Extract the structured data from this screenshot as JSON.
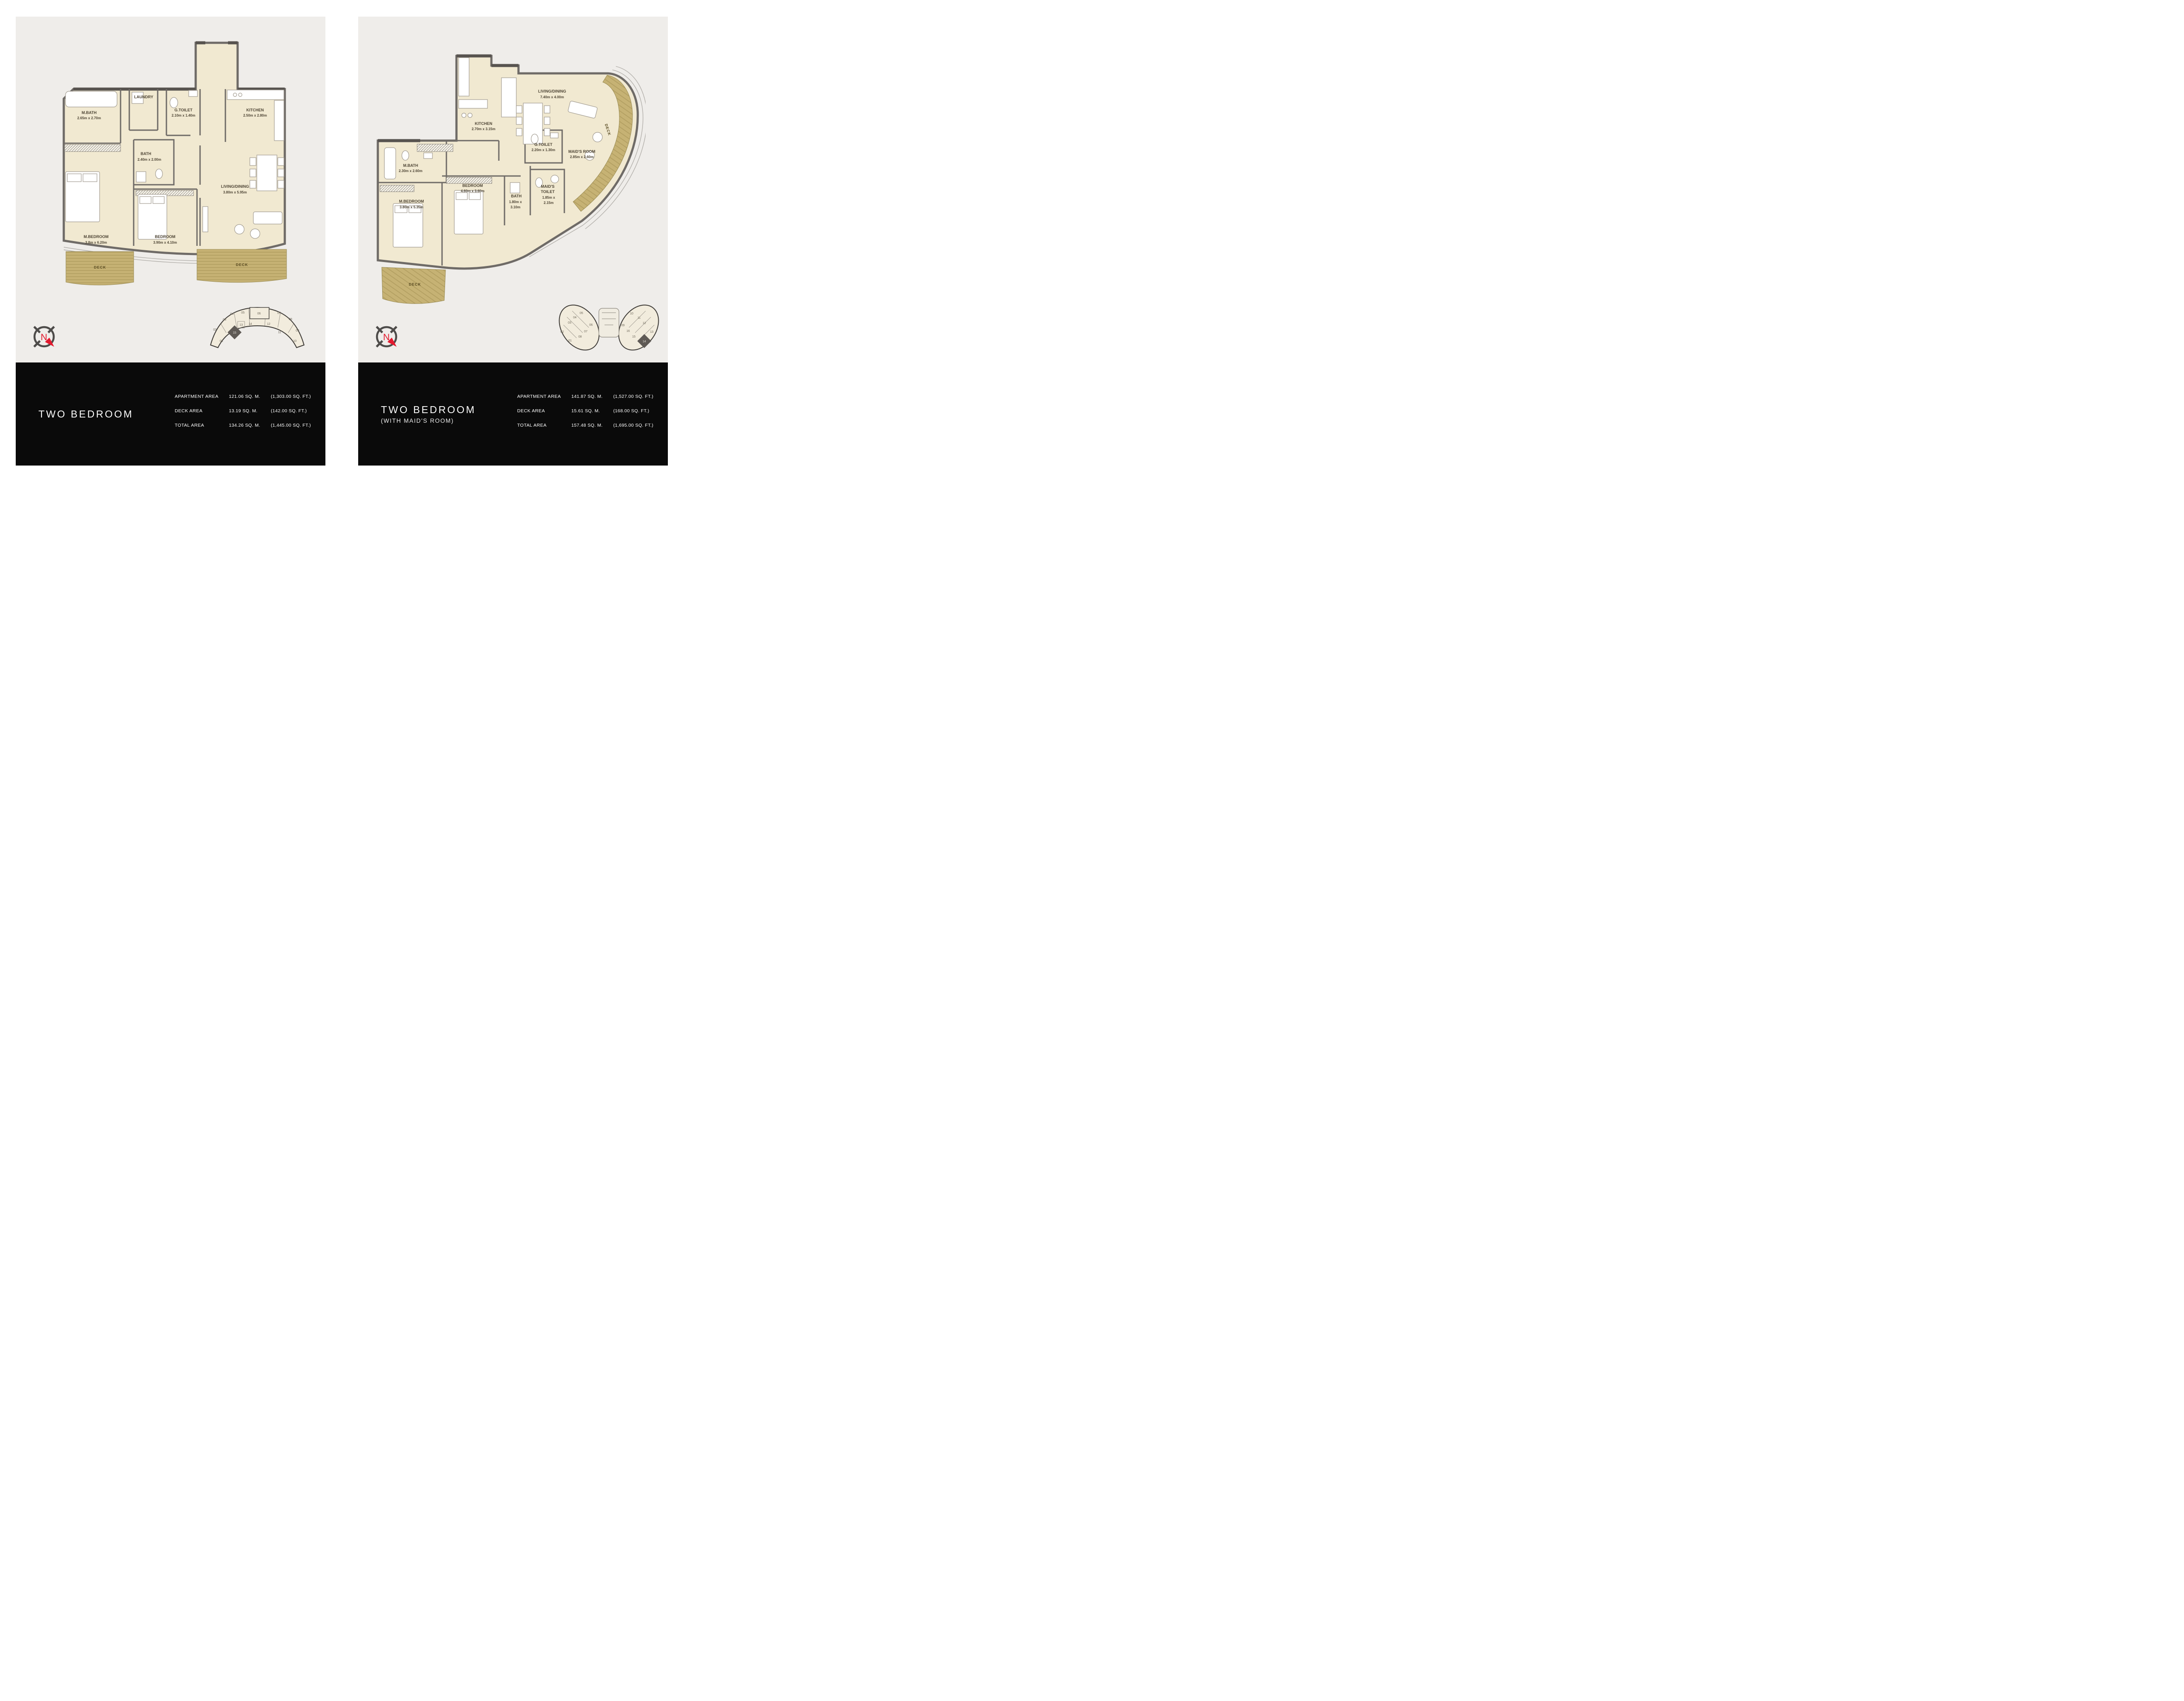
{
  "left_sheet": {
    "plan": {
      "rooms": {
        "mbath": {
          "name": "M.BATH",
          "dims": "2.65m x 2.70m"
        },
        "laundry": {
          "name": "LAUNDRY"
        },
        "gtoilet": {
          "name": "G.TOILET",
          "dims": "2.10m x 1.40m"
        },
        "kitchen": {
          "name": "KITCHEN",
          "dims": "2.50m x 2.80m"
        },
        "bath": {
          "name": "BATH",
          "dims": "2.40m x 2.00m"
        },
        "living": {
          "name": "LIVING/DINING",
          "dims": "3.80m x 5.95m"
        },
        "mbedroom": {
          "name": "M.BEDROOM",
          "dims": "3.8m x 6.20m"
        },
        "bedroom": {
          "name": "BEDROOM",
          "dims": "3.90m x 4.10m"
        },
        "deck_left": {
          "name": "DECK"
        },
        "deck_right": {
          "name": "DECK"
        }
      },
      "compass_label": "N"
    },
    "keyplan": {
      "units": [
        "01",
        "02",
        "03",
        "04",
        "05",
        "06",
        "07",
        "08",
        "09",
        "10",
        "11",
        "12",
        "13",
        "14",
        "15"
      ],
      "highlighted_unit": "15"
    },
    "info": {
      "title": "TWO BEDROOM",
      "rows": [
        {
          "label": "APARTMENT AREA",
          "metric": "121.06 SQ. M.",
          "imperial": "(1,303.00 SQ. FT.)"
        },
        {
          "label": "DECK AREA",
          "metric": "13.19 SQ. M.",
          "imperial": "(142.00 SQ. FT.)"
        },
        {
          "label": "TOTAL AREA",
          "metric": "134.26 SQ. M.",
          "imperial": "(1,445.00 SQ. FT.)"
        }
      ]
    }
  },
  "right_sheet": {
    "plan": {
      "rooms": {
        "kitchen": {
          "name": "KITCHEN",
          "dims": "2.70m x 3.15m"
        },
        "living": {
          "name": "LIVING/DINING",
          "dims": "7.40m x 4.00m"
        },
        "gtoilet": {
          "name": "G.TOILET",
          "dims": "2.20m x 1.30m"
        },
        "maids_room": {
          "name": "MAID'S ROOM",
          "dims": "2.85m x 2.60m"
        },
        "mbath": {
          "name": "M.BATH",
          "dims": "2.30m x 2.60m"
        },
        "bedroom": {
          "name": "BEDROOM",
          "dims": "4.60m x 3.60m"
        },
        "bath": {
          "name": "BATH",
          "dims1": "1.80m x",
          "dims2": "3.10m"
        },
        "maids_toilet": {
          "name1": "MAID'S",
          "name2": "TOILET",
          "dims1": "1.85m x",
          "dims2": "2.15m"
        },
        "mbedroom": {
          "name": "M.BEDROOM",
          "dims": "3.80m x 5.35m"
        },
        "deck_arc": {
          "name": "DECK"
        },
        "deck_bottom": {
          "name": "DECK"
        }
      },
      "compass_label": "N"
    },
    "keyplan": {
      "units": [
        "01",
        "02",
        "03",
        "04",
        "05",
        "06",
        "07",
        "08",
        "09",
        "10",
        "11",
        "12",
        "13",
        "14",
        "15",
        "16"
      ],
      "highlighted_unit": "14"
    },
    "info": {
      "title": "TWO BEDROOM",
      "subtitle": "(WITH MAID'S ROOM)",
      "rows": [
        {
          "label": "APARTMENT AREA",
          "metric": "141.87 SQ. M.",
          "imperial": "(1,527.00 SQ. FT.)"
        },
        {
          "label": "DECK AREA",
          "metric": "15.61 SQ. M.",
          "imperial": "(168.00 SQ. FT.)"
        },
        {
          "label": "TOTAL AREA",
          "metric": "157.48 SQ. M.",
          "imperial": "(1,695.00 SQ. FT.)"
        }
      ]
    }
  },
  "colors": {
    "panel_bg": "#efedea",
    "panel_dark": "#0a0a0a",
    "wall": "#6f6b67",
    "floor": "#f1e9d1",
    "deck": "#c6b274",
    "deck_stripe": "#b09d5f",
    "accent_red": "#e3192e",
    "key_highlight": "#5f5a55"
  }
}
